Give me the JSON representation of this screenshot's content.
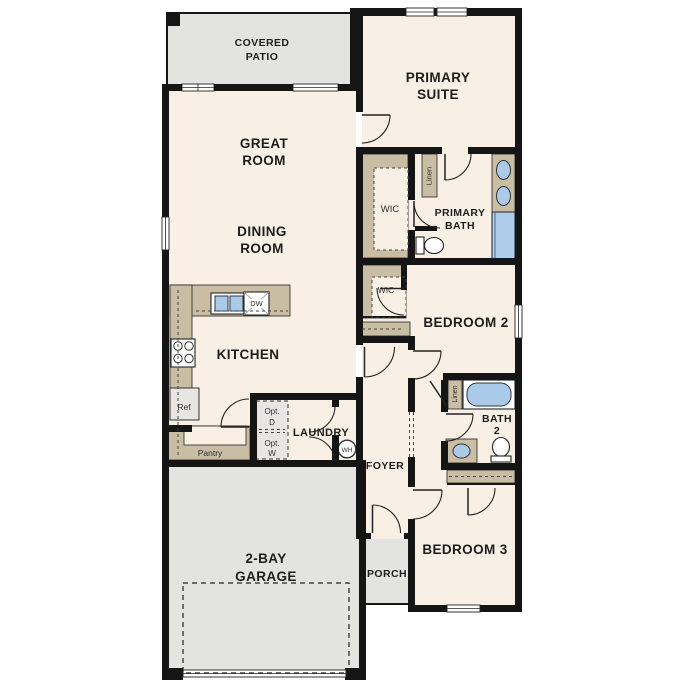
{
  "floorplan": {
    "rooms": {
      "covered_patio": [
        "COVERED",
        "PATIO"
      ],
      "great_room": [
        "GREAT",
        "ROOM"
      ],
      "dining_room": [
        "DINING",
        "ROOM"
      ],
      "primary_suite": [
        "PRIMARY",
        "SUITE"
      ],
      "primary_bath": [
        "PRIMARY",
        "BATH"
      ],
      "wic_primary": "WIC",
      "wic_bedroom2": "WIC",
      "bedroom_2": "BEDROOM 2",
      "bedroom_3": "BEDROOM 3",
      "bath_2": [
        "BATH",
        "2"
      ],
      "kitchen": "KITCHEN",
      "laundry": "LAUNDRY",
      "foyer": "FOYER",
      "porch": "PORCH",
      "garage": [
        "2-BAY",
        "GARAGE"
      ]
    },
    "fixtures": {
      "linen_primary": "Linen",
      "linen_hall": "Linen",
      "pantry": "Pantry",
      "refrigerator": "Ref",
      "dishwasher": "DW",
      "water_heater": "WH",
      "optional_dryer": [
        "Opt.",
        "D"
      ],
      "optional_washer": [
        "Opt.",
        "W"
      ]
    },
    "colors": {
      "wall": "#151515",
      "interior_fill": "#f8f0e4",
      "outdoor_fill": "#e3e3e1",
      "casework_fill": "#c9bda4",
      "appliance_fill": "#e7e6e3",
      "fixture_blue": "#a9cbe9",
      "background": "#ffffff"
    }
  }
}
